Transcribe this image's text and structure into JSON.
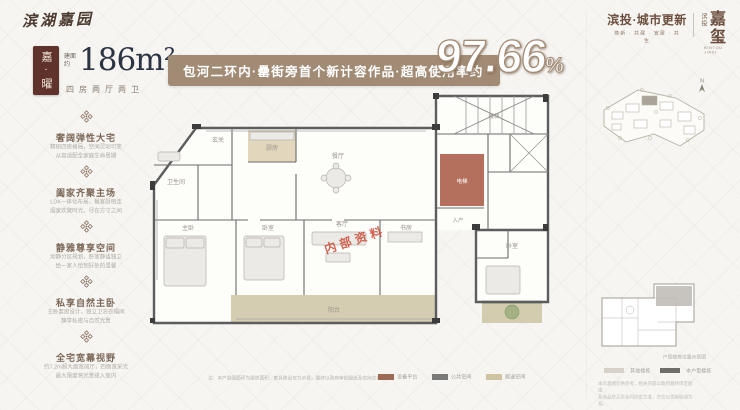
{
  "brand": {
    "logo": "滨湖嘉园"
  },
  "unit": {
    "badge": "嘉·曜",
    "area_prefix": "建面约",
    "area": "186m²",
    "layout": "四房两厅两卫"
  },
  "banner": {
    "text": "包河二环内·罍街旁首个新计容作品·超高使用率约",
    "number": "97.66",
    "percent": "%"
  },
  "features": [
    {
      "title": "奢阔弹性大宅",
      "line1": "精研四房格局，空间灵动可变",
      "line2": "从容适配全家庭生命周期"
    },
    {
      "title": "阖家齐聚主场",
      "line1": "LDK一体化布局，餐客厨相连",
      "line2": "阖家欢聚时光，尽在方寸之间"
    },
    {
      "title": "静雅尊享空间",
      "line1": "动静分区规划，卧室静谧独立",
      "line2": "给一家人恰到好处的温馨"
    },
    {
      "title": "私享自然主卧",
      "line1": "主卧套房设计，独立卫浴衣帽间",
      "line2": "静享私密与自然光景"
    },
    {
      "title": "全宅宽幕视野",
      "line1": "约7.2m超大面宽阔厅，四面宽采光",
      "line2": "最大限度将光景揽入室内"
    }
  ],
  "floorplan": {
    "watermark": "内部资料",
    "rooms": {
      "bath": "卫生间",
      "kitchen": "厨房",
      "dining": "餐厅",
      "entry": "玄关",
      "living": "客厅",
      "master": "主卧",
      "bed2": "卧室",
      "study": "书房",
      "balcony": "阳台",
      "stairs": "楼梯",
      "lift": "电梯",
      "bed3": "卧室",
      "hall": "入户"
    }
  },
  "logos": {
    "left_title": "滨投·城市更新",
    "left_sub": "焕新 · 共建 · 宜居 · 共生",
    "right_prefix": "滨投",
    "right_name": "嘉玺",
    "right_sub": "BINTOU JIAXI"
  },
  "sidebar": {
    "compass": "N",
    "keyplan_caption": "户型楼栋位置示意图",
    "legend": [
      {
        "label": "其他楼栋"
      },
      {
        "label": "本户型楼栋"
      }
    ],
    "disclaimer_line1": "本示意图仅供参考，相关内容以政府最终审定图纸",
    "disclaimer_line2": "及商品房买卖合同约定为准，方位以实际勘测为准。"
  },
  "footer": {
    "disclaimer": "注：本户型图面积为建筑面积，家具陈设仅为示意，最终以政府审批图纸及实际交付为准。",
    "legend": [
      {
        "label": "设备平台",
        "color": "#9c6a55"
      },
      {
        "label": "公共空间",
        "color": "#7a7a78"
      },
      {
        "label": "赠送空间",
        "color": "#cfc3a2"
      }
    ]
  },
  "colors": {
    "badge": "#5f332c",
    "banner": "#a28b75",
    "red_room": "#b4705c",
    "balcony": "#cdc4a3",
    "watermark": "#cc4b38",
    "brand": "#6d4f3f",
    "ink": "#2c3444"
  }
}
